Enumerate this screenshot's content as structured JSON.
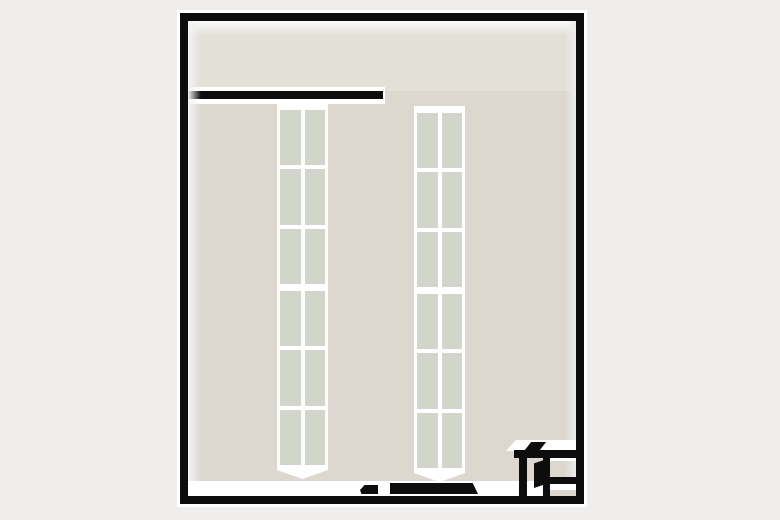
{
  "scene": {
    "type": "floor-plan",
    "description": "Top-down 3D-rendered floor plan of a rectangular room with two tall shelving units, an upper corridor separated by a partial interior wall, dark door slabs along the bottom wall, and a small corner closet with shelves and an open door in the bottom-right corner",
    "text_content": "none"
  },
  "colors": {
    "page_bg": "#efeeec",
    "wall": "#0d0d0d",
    "floor_main": "#dcd8d0",
    "floor_upper": "#e3e0d8",
    "shelf_frame": "#ffffff",
    "shelf_panel": "#d2d5c9",
    "highlight": "#ffffff"
  },
  "floorplan": {
    "room": {
      "shape": "rectangle",
      "wall_color": "#0d0d0d",
      "wall_thickness_px": 8,
      "outer_outline": "white"
    },
    "upper_corridor": {
      "present": true,
      "position": "top",
      "separated_by": "partial interior wall attached to left wall"
    },
    "interior_wall": {
      "orientation": "horizontal",
      "attached_to": "left wall",
      "open_end": "right"
    },
    "shelving_units": [
      {
        "id": "left",
        "sections": 2,
        "rows_per_section": 3,
        "columns": 2,
        "panel_color": "#d2d5c9"
      },
      {
        "id": "right",
        "sections": 2,
        "rows_per_section": 3,
        "columns": 2,
        "panel_color": "#d2d5c9"
      }
    ],
    "bottom_openings": [
      {
        "id": "small-slab",
        "shape": "notched rectangle"
      },
      {
        "id": "wide-slab",
        "shape": "slanted rectangle"
      }
    ],
    "closet": {
      "position": "bottom-right",
      "compartments": 2,
      "shelves_right_compartment": 2,
      "door_state": "open",
      "counter_item": "dark slanted fixture on top wall"
    }
  }
}
